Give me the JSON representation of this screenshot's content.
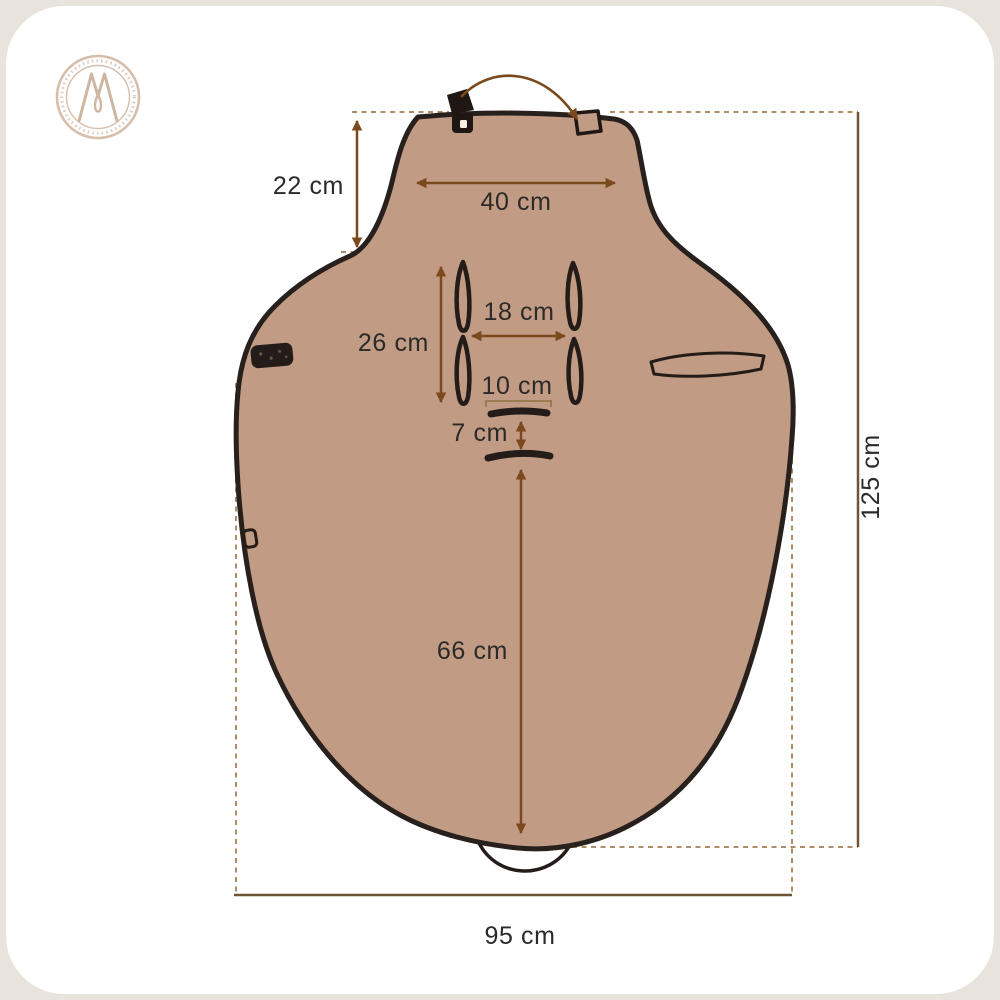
{
  "meta": {
    "title": "Footmuff / seat cover dimensions diagram"
  },
  "theme": {
    "page_bg": "#e9e4db",
    "card_bg": "#ffffff",
    "fabric_fill": "#c19b83",
    "fabric_outline": "#27201c",
    "arrow_color": "#7a4a1e",
    "guide_dash_color": "#b08d66",
    "extent_line_color": "#6d5637",
    "label_color": "#2b2a28",
    "logo_color": "#d5bfac"
  },
  "logo": {
    "monogram": "M"
  },
  "dimensions": {
    "hood_height": "22 cm",
    "top_width": "40 cm",
    "harness_slot_height": "26 cm",
    "harness_slot_gap": "18 cm",
    "crotch_slot_width": "10 cm",
    "crotch_slot_gap": "7 cm",
    "seat_length": "66 cm",
    "total_length": "125 cm",
    "total_width": "95 cm"
  }
}
